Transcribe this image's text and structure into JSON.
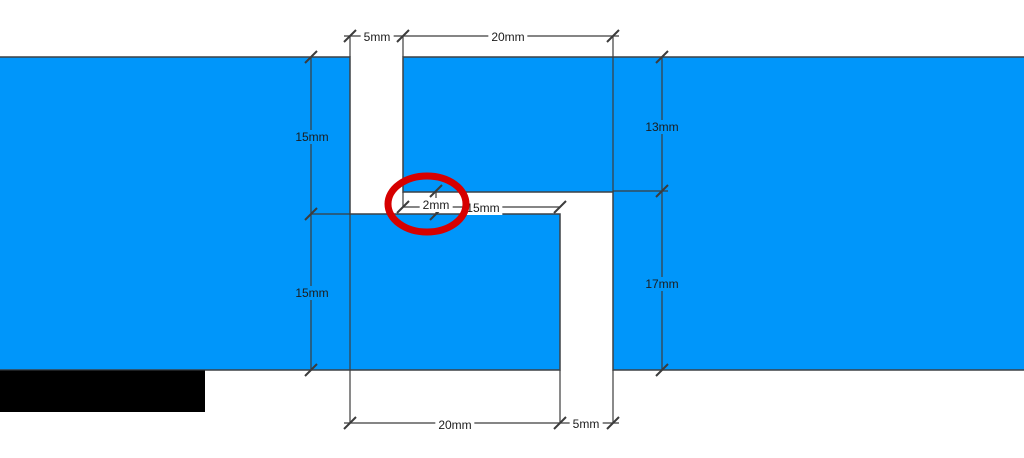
{
  "colors": {
    "part_blue": "#0096fa",
    "outline": "#3d4145",
    "dimension_line": "#3c3c3c",
    "label_text": "#1c1c1c",
    "highlight_red": "#d60000",
    "mask_black": "#000000",
    "background": "#ffffff"
  },
  "diagram": {
    "type": "dimensioned-part-drawing",
    "labels": {
      "top_gap": "5mm",
      "top_tab": "20mm",
      "left_upper": "15mm",
      "left_lower": "15mm",
      "right_upper": "13mm",
      "right_lower": "17mm",
      "middle_overlap": "15mm",
      "middle_gap": "2mm",
      "bottom_tab": "20mm",
      "bottom_gap": "5mm"
    }
  }
}
